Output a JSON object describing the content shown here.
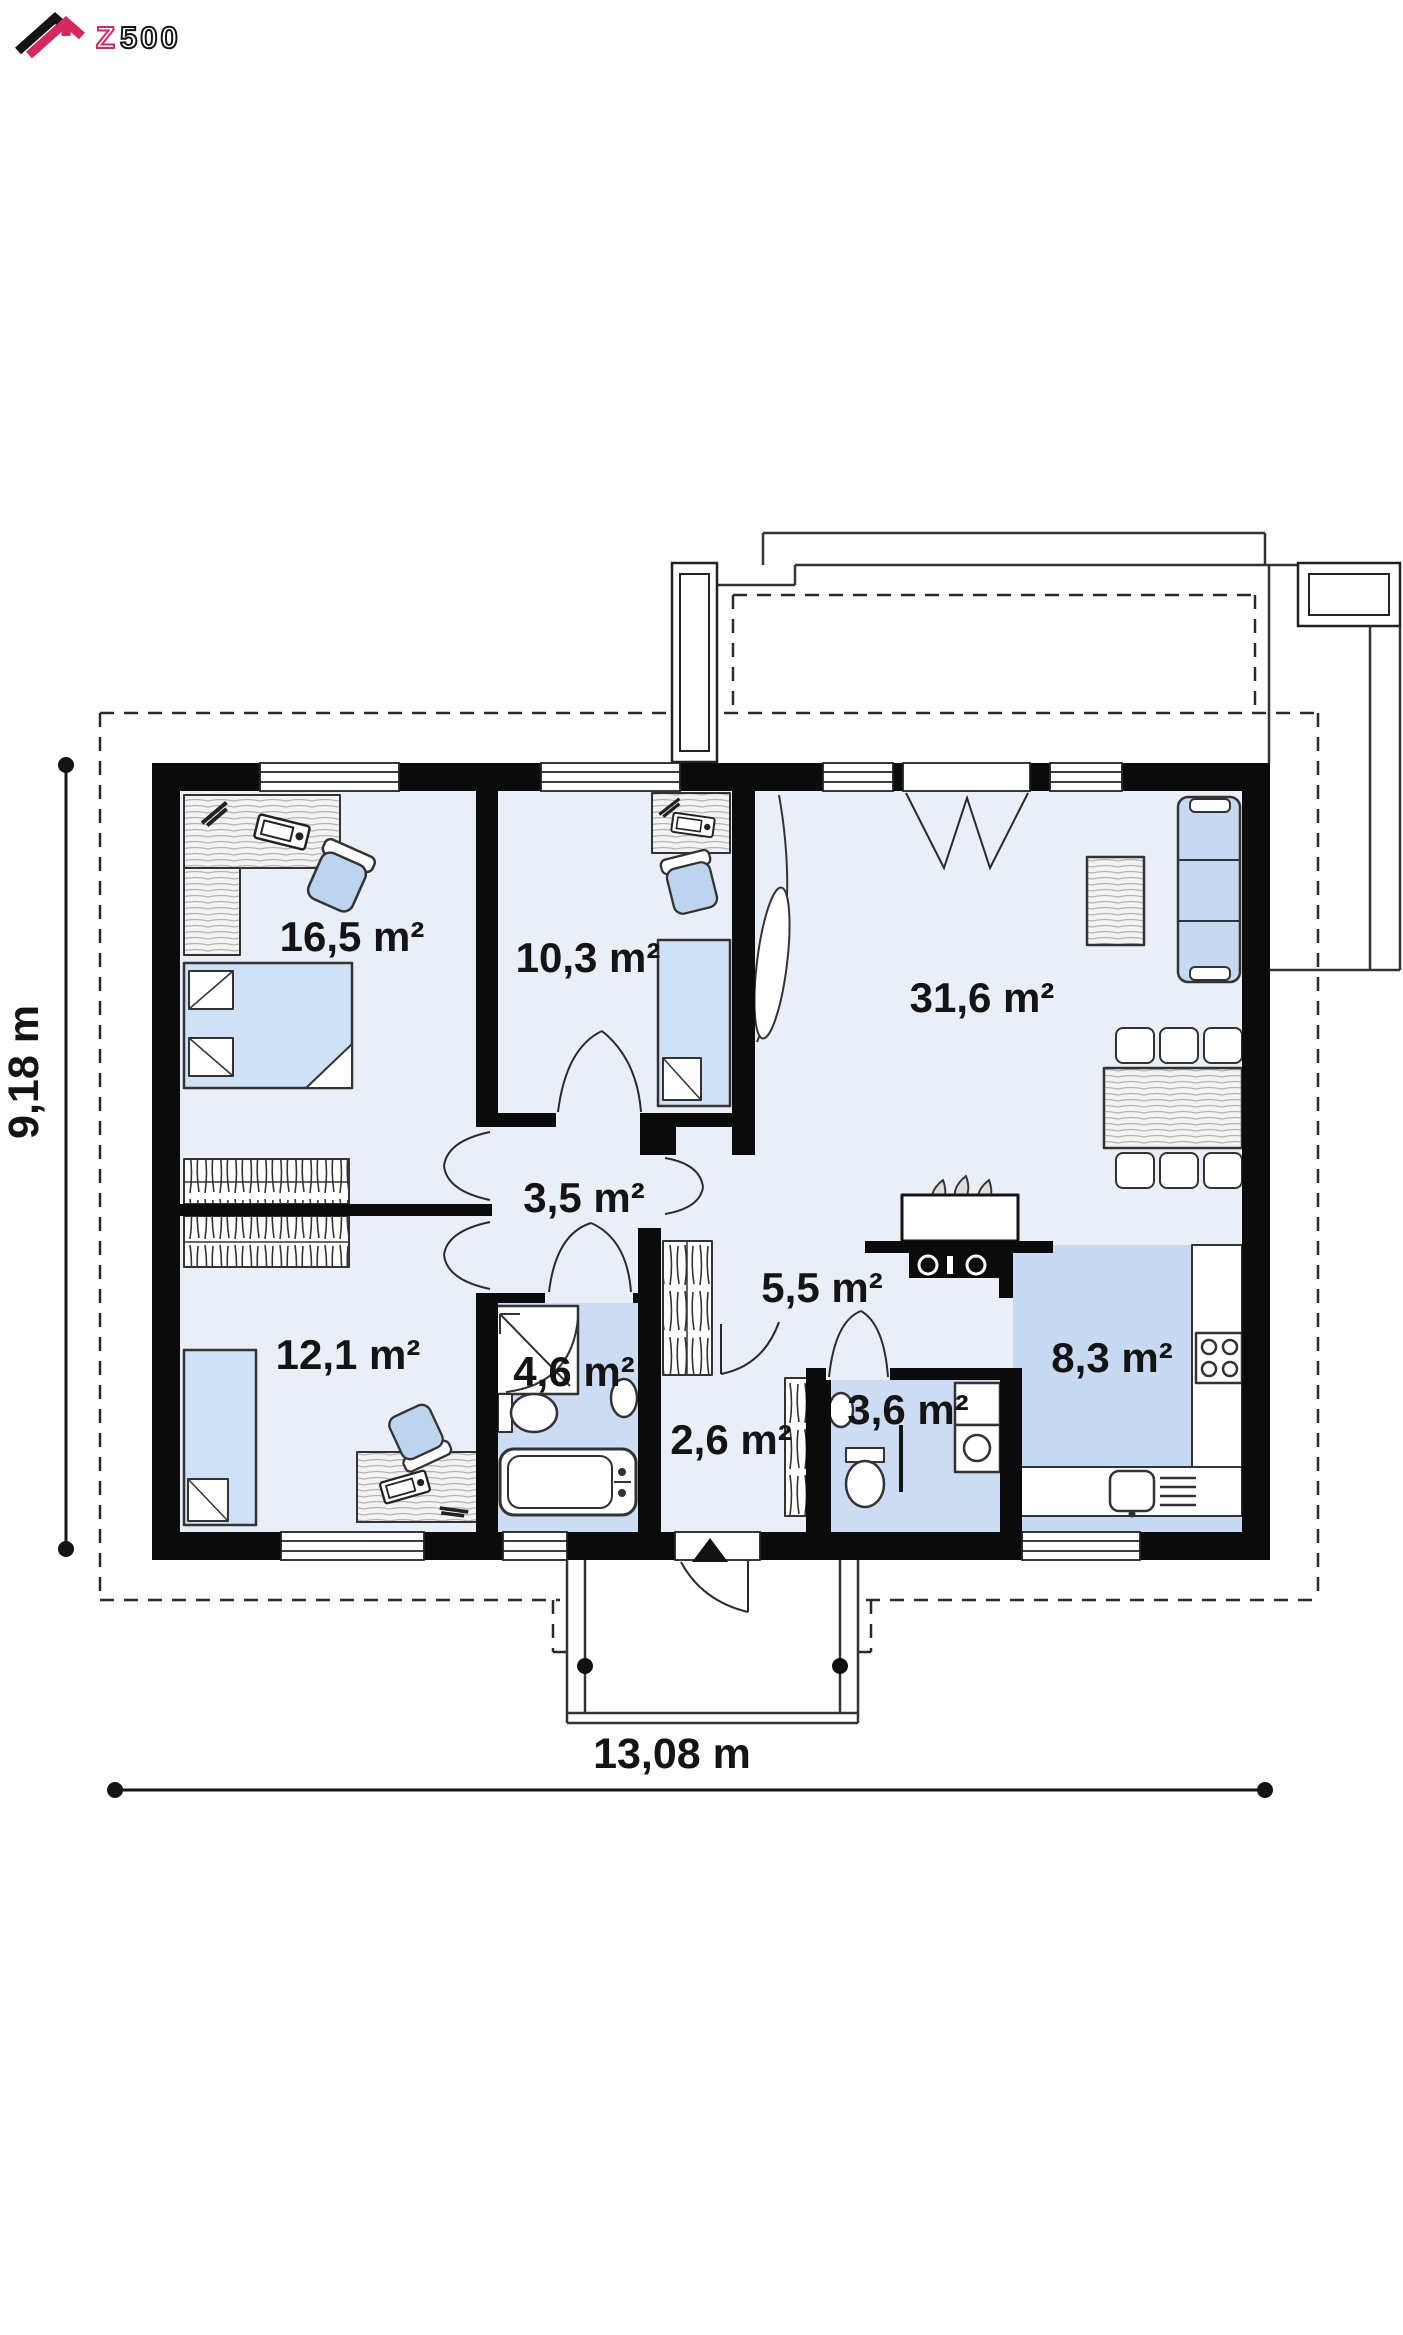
{
  "brand": {
    "logo_z": "Z",
    "logo_number": "500",
    "accent_color": "#d6275e"
  },
  "floor_plan": {
    "rooms": [
      {
        "id": "bedroom-large",
        "area": "16,5 m²"
      },
      {
        "id": "bedroom-middle",
        "area": "10,3 m²"
      },
      {
        "id": "living-room",
        "area": "31,6 m²"
      },
      {
        "id": "hall",
        "area": "3,5 m²"
      },
      {
        "id": "bedroom-small",
        "area": "12,1 m²"
      },
      {
        "id": "bathroom",
        "area": "4,6 m²"
      },
      {
        "id": "vestibule",
        "area": "2,6 m²"
      },
      {
        "id": "corridor",
        "area": "5,5 m²"
      },
      {
        "id": "wc",
        "area": "3,6 m²"
      },
      {
        "id": "kitchen",
        "area": "8,3 m²"
      }
    ],
    "overall_width": "13,08 m",
    "overall_depth": "9,18 m",
    "colors": {
      "wall": "#0b0b0b",
      "room_fill": "#e9eef7",
      "wet_room_fill": "#ccdcf2",
      "furniture_fill": "#cfe1f4",
      "outline": "#222222"
    }
  }
}
